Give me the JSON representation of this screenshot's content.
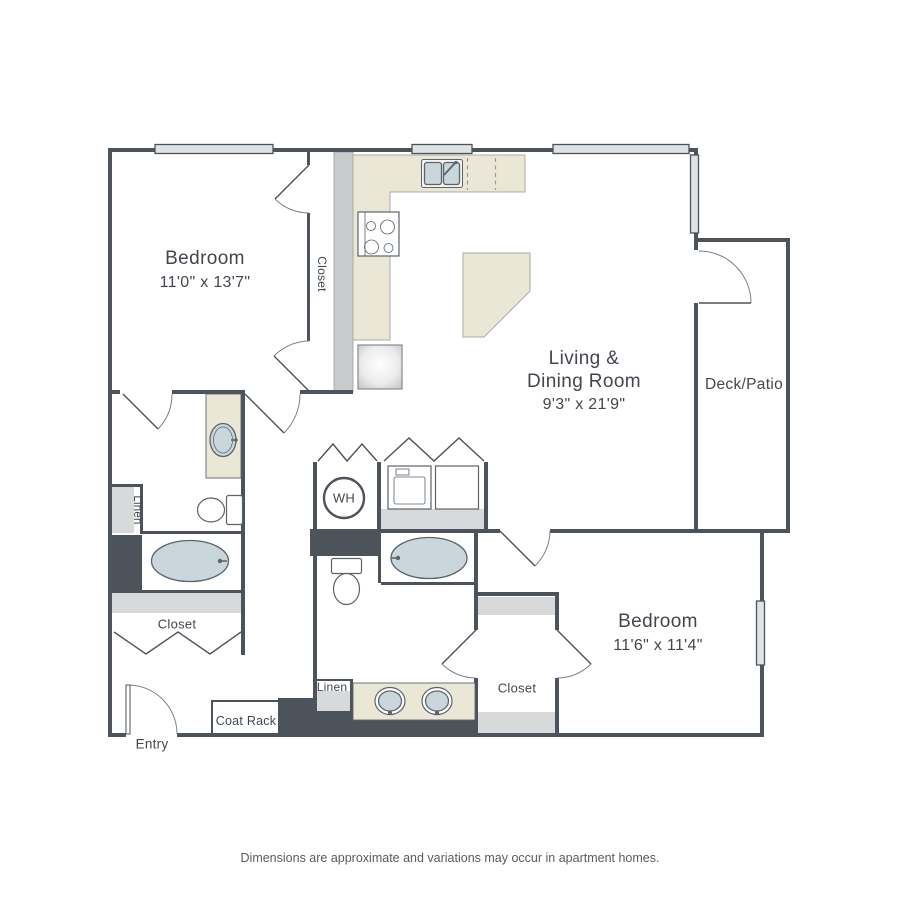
{
  "plan": {
    "bedroom1": {
      "name": "Bedroom",
      "dims": "11'0\" x 13'7\"",
      "closet": "Closet"
    },
    "bath1": {
      "linen": "Linen",
      "closet": "Closet"
    },
    "living": {
      "line1": "Living &",
      "line2": "Dining Room",
      "dims": "9'3\" x 21'9\""
    },
    "deck": {
      "name": "Deck/Patio"
    },
    "entry": {
      "name": "Entry",
      "coat_rack": "Coat Rack"
    },
    "utility": {
      "water_heater": "WH"
    },
    "bath2": {
      "linen": "Linen"
    },
    "bedroom2": {
      "name": "Bedroom",
      "dims": "11'6\" x 11'4\"",
      "closet": "Closet"
    },
    "colors": {
      "wall": "#4d535a",
      "counter": "#ebe7d6",
      "fixture": "#c9d7dc",
      "shelf": "#d8d9da",
      "window": "#e0e3e5",
      "band": "#c9cbcd",
      "text": "#42474e"
    }
  },
  "footer": {
    "disclaimer": "Dimensions are approximate and variations may occur in apartment homes."
  }
}
